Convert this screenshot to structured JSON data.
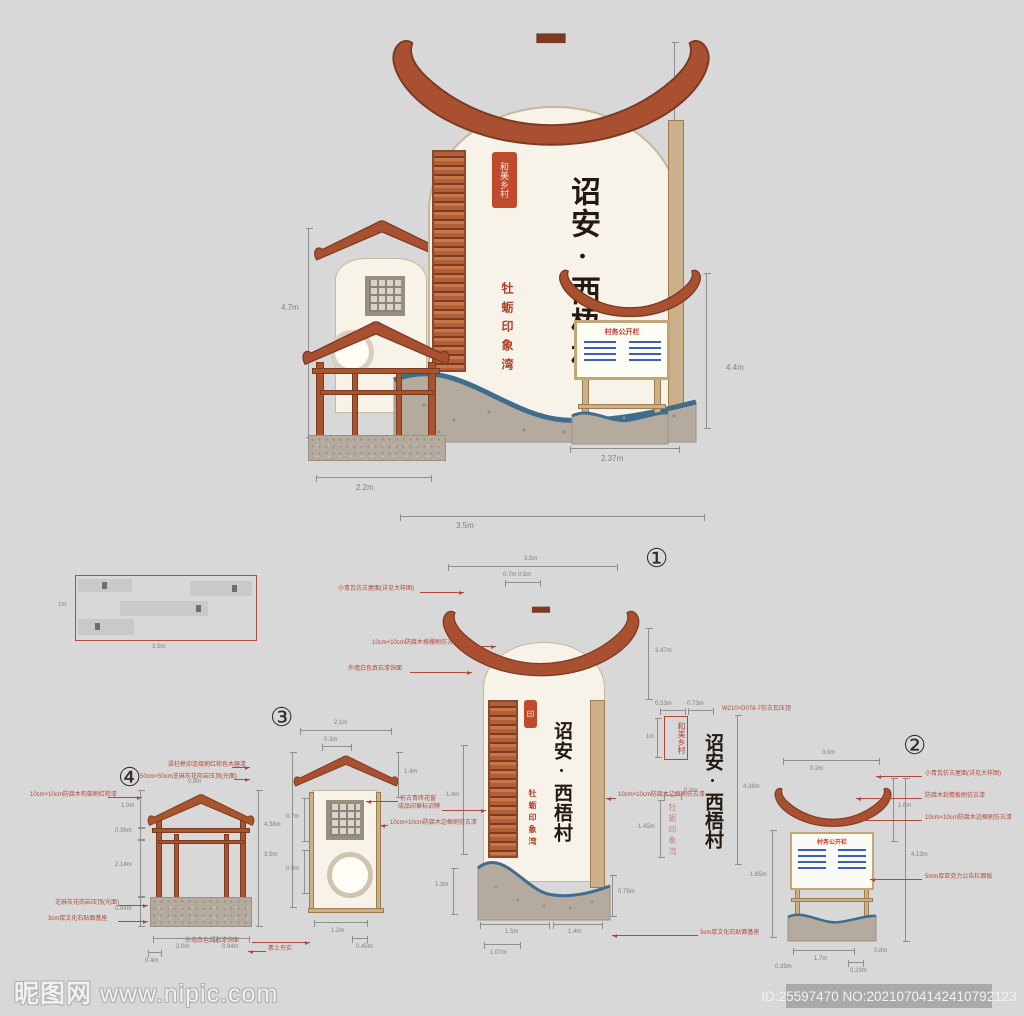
{
  "colors": {
    "bg": "#d8d8d8",
    "roof": "#a8502f",
    "roof_dark": "#7b3a22",
    "wall": "#f8f3e8",
    "wood": "#cbb089",
    "stone": "#b4ab9e",
    "wave": "#3f6d8e",
    "annotation": "#b2483a",
    "dim": "#808080",
    "seal": "#bf4a2e",
    "notice_blue": "#3a5fb8"
  },
  "r3d": {
    "seal": "和美乡村",
    "title": "诏安·西梧村",
    "subtitle": "牡蛎印象湾",
    "board_title": "村务公开栏",
    "dims": {
      "total_h": "10m",
      "mid_h": "4.7m",
      "board_h": "4.4m",
      "gazebo_w": "2.2m",
      "board_w": "2.37m",
      "total_w": "3.5m"
    }
  },
  "plan": {
    "w": "3.5m",
    "side": "1m"
  },
  "d1": {
    "num": "①",
    "title": "诏安·西梧村",
    "subtitle": "牡蛎印象湾",
    "seal": "印",
    "dims": {
      "top": "3.5m",
      "top_sub": "0.7m 0.5m",
      "roof_h": "3.47m",
      "lat_h": "1.4m",
      "base_h": "1.3m",
      "b1": "1.5m",
      "b2": "1.4m",
      "b3": "1.07m",
      "base_r": "0.75m"
    },
    "type": {
      "seal_w": "0.53m",
      "seal_h": "0.73m",
      "seal_side": "1m",
      "title_h": "4.38m",
      "sub_top": "0.3m",
      "sub_h": "1.45m",
      "seal_text": "和美乡村"
    },
    "anns_left": [
      "小青瓦仿古屋面(详见大样图)",
      "10cm×10cm防腐木格栅刷仿古漆",
      "外墙白色真石漆饰面",
      "成品印章标识牌"
    ],
    "ann_roof_r": "W210×D078-7仿古瓦压顶",
    "ann_rail": "10cm×10cm防腐木边框刷仿古漆",
    "ann_base": "3cm厚文化石贴面基座"
  },
  "d2": {
    "num": "②",
    "board_title": "村务公开栏",
    "dims": {
      "top": "3.0m",
      "tip": "0.2m",
      "roof_h": "1.6m",
      "total_h": "4.13m",
      "left_h": "1.65m",
      "b1": "1.7m",
      "b2": "0.35m",
      "b3": "0.23m",
      "base_r": "0.8m"
    },
    "anns": [
      "小青瓦仿古屋面(详见大样图)",
      "防腐木封檐板刷仿古漆",
      "10cm×10cm防腐木边框刷仿古漆",
      "5mm厚亚克力公告栏面板",
      "3cm厚文化石贴面基座"
    ]
  },
  "d3": {
    "num": "③",
    "dims": {
      "top": "2.1m",
      "top_sub": "0.3m",
      "total_h": "4.38m",
      "seg1": "0.7m",
      "seg2": "0.9m",
      "roof_h": "1.4m",
      "b1": "1.2m",
      "b2": "0.45m"
    },
    "anns": [
      "仿古青砖花窗",
      "10cm×10cm防腐木边框刷仿古漆",
      "外墙白色真石漆饰面"
    ]
  },
  "d4": {
    "num": "④",
    "dims": {
      "apex": "0.8m",
      "l1": "1.0m",
      "l2": "0.36m",
      "l3": "2.14m",
      "l4": "0.94m",
      "total": "3.5m",
      "b1": "0.4m",
      "b2": "2.0m",
      "b3": "0.94m"
    },
    "anns": [
      "梁柱榫卯连接刷红棕色木器漆",
      "50cm×50cm芝麻灰花岗岩压顶(光面)",
      "10cm×10cm防腐木构架刷红棕漆",
      "芝麻灰花岗岩压顶(光面)",
      "3cm厚文化石贴面基座",
      "素土夯实"
    ]
  },
  "footer": {
    "site_cn": "昵图网",
    "site_url": "www.nipic.com",
    "badge": "ID:25597470 NO:20210704142410792123"
  }
}
